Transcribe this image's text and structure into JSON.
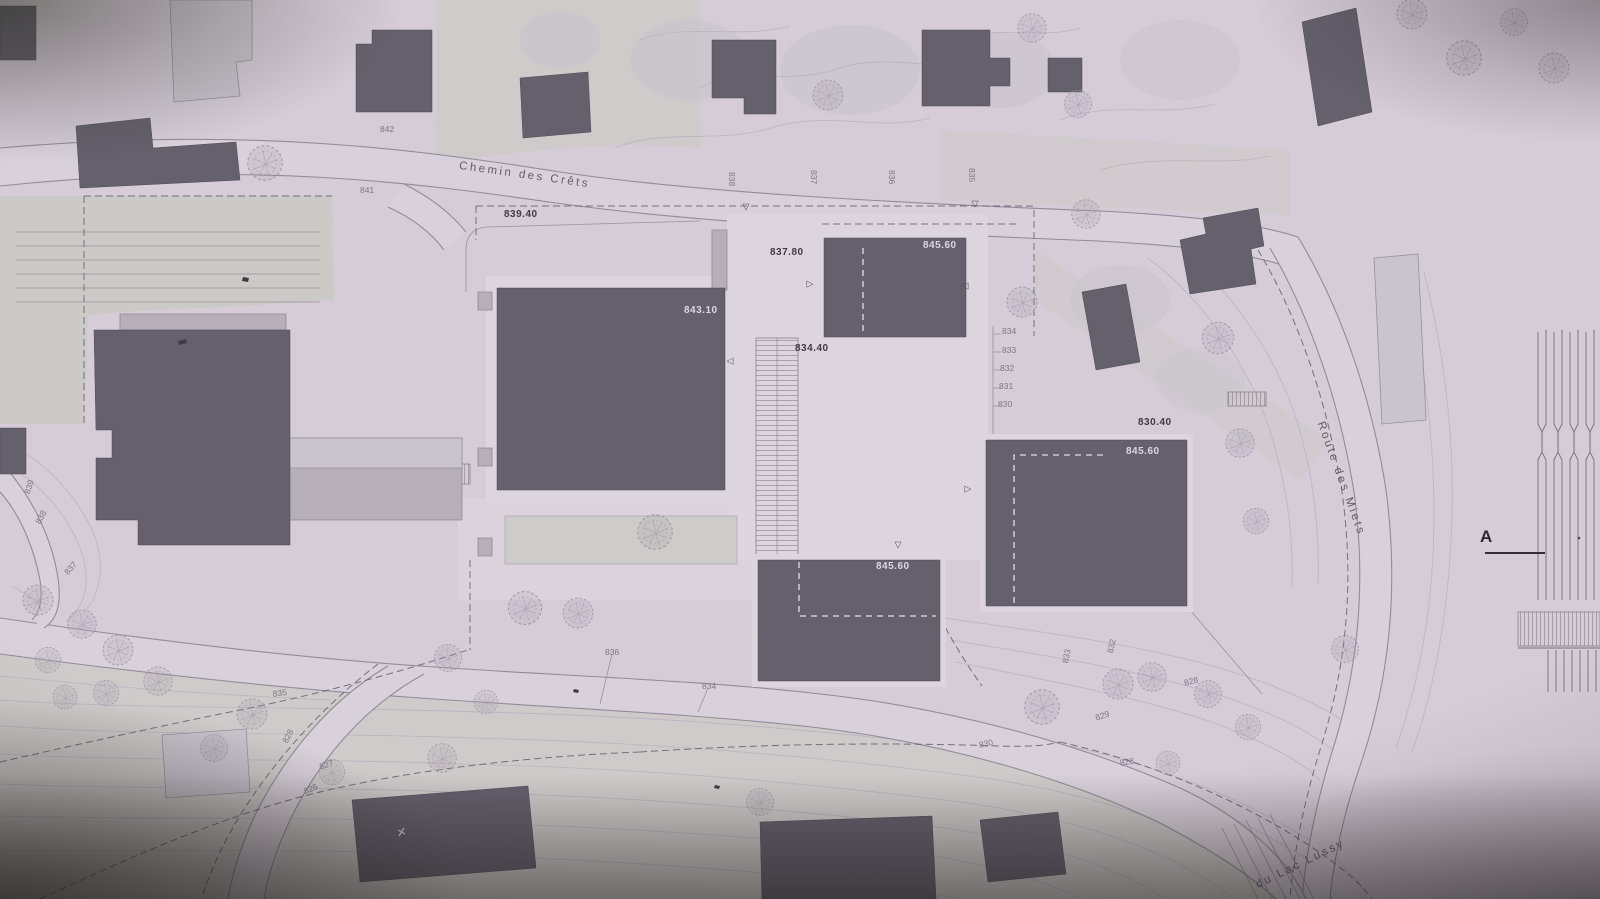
{
  "section": {
    "label": "A"
  },
  "colors": {
    "paper": "#d5cdd7",
    "paper_bright": "#ded7df",
    "parcel": "#c9cbc1",
    "road_fill": "#d9d2da",
    "road_edge": "#8f8996",
    "contour_line": "#b2a9bd",
    "building_dark": "#5e5c67",
    "building_mid": "#b4afb8",
    "building_light": "#c9c5cd",
    "dash_dark": "#5f5a66",
    "label_dark": "#39343f",
    "label_light": "#dcd8e3",
    "label_contour": "#6f6a78",
    "street_label": "#5d5765",
    "marker": "#4c4754",
    "fleck": "#38343e"
  },
  "marker_glyphs": {
    "down": "▽",
    "right": "▷",
    "left": "◁"
  },
  "markers": [
    {
      "type": "down",
      "x": 746,
      "y": 207
    },
    {
      "type": "down",
      "x": 975,
      "y": 204
    },
    {
      "type": "down",
      "x": 898,
      "y": 545
    },
    {
      "type": "right",
      "x": 810,
      "y": 284
    },
    {
      "type": "right",
      "x": 968,
      "y": 489
    },
    {
      "type": "left",
      "x": 965,
      "y": 286
    },
    {
      "type": "left",
      "x": 730,
      "y": 361
    }
  ],
  "labels": [
    {
      "text": "Chemin des Crêts",
      "x": 460,
      "y": 160,
      "rot": 8,
      "cls": "street"
    },
    {
      "text": "Route des Miets",
      "x": 1326,
      "y": 420,
      "rot": 70,
      "cls": "street"
    },
    {
      "text": "du Lac Lussy",
      "x": 1254,
      "y": 880,
      "rot": -26,
      "cls": "street"
    },
    {
      "text": "839.40",
      "x": 504,
      "y": 209,
      "rot": 0,
      "cls": "elev"
    },
    {
      "text": "837.80",
      "x": 770,
      "y": 247,
      "rot": 0,
      "cls": "elev"
    },
    {
      "text": "834.40",
      "x": 795,
      "y": 343,
      "rot": 0,
      "cls": "elev"
    },
    {
      "text": "830.40",
      "x": 1138,
      "y": 417,
      "rot": 0,
      "cls": "elev"
    },
    {
      "text": "843.10",
      "x": 684,
      "y": 305,
      "rot": 0,
      "cls": "roof"
    },
    {
      "text": "845.60",
      "x": 923,
      "y": 240,
      "rot": 0,
      "cls": "roof"
    },
    {
      "text": "845.60",
      "x": 1126,
      "y": 446,
      "rot": 0,
      "cls": "roof"
    },
    {
      "text": "845.60",
      "x": 876,
      "y": 561,
      "rot": 0,
      "cls": "roof"
    },
    {
      "text": "842",
      "x": 380,
      "y": 124,
      "rot": 0,
      "cls": "contour"
    },
    {
      "text": "841",
      "x": 360,
      "y": 185,
      "rot": 0,
      "cls": "contour"
    },
    {
      "text": "838",
      "x": 737,
      "y": 172,
      "rot": 90,
      "cls": "contour"
    },
    {
      "text": "837",
      "x": 819,
      "y": 170,
      "rot": 90,
      "cls": "contour"
    },
    {
      "text": "836",
      "x": 897,
      "y": 170,
      "rot": 90,
      "cls": "contour"
    },
    {
      "text": "835",
      "x": 977,
      "y": 168,
      "rot": 90,
      "cls": "contour"
    },
    {
      "text": "834",
      "x": 1002,
      "y": 326,
      "rot": 0,
      "cls": "contour"
    },
    {
      "text": "833",
      "x": 1002,
      "y": 345,
      "rot": 0,
      "cls": "contour"
    },
    {
      "text": "832",
      "x": 1000,
      "y": 363,
      "rot": 0,
      "cls": "contour"
    },
    {
      "text": "831",
      "x": 999,
      "y": 381,
      "rot": 0,
      "cls": "contour"
    },
    {
      "text": "830",
      "x": 998,
      "y": 399,
      "rot": 0,
      "cls": "contour"
    },
    {
      "text": "839",
      "x": 22,
      "y": 492,
      "rot": -72,
      "cls": "contour"
    },
    {
      "text": "838",
      "x": 33,
      "y": 521,
      "rot": -62,
      "cls": "contour"
    },
    {
      "text": "837",
      "x": 62,
      "y": 570,
      "rot": -48,
      "cls": "contour"
    },
    {
      "text": "836",
      "x": 605,
      "y": 647,
      "rot": 0,
      "cls": "contour"
    },
    {
      "text": "834",
      "x": 702,
      "y": 681,
      "rot": 0,
      "cls": "contour"
    },
    {
      "text": "835",
      "x": 272,
      "y": 689,
      "rot": -8,
      "cls": "contour"
    },
    {
      "text": "828",
      "x": 280,
      "y": 740,
      "rot": -62,
      "cls": "contour"
    },
    {
      "text": "827",
      "x": 318,
      "y": 762,
      "rot": -18,
      "cls": "contour"
    },
    {
      "text": "826",
      "x": 302,
      "y": 787,
      "rot": -24,
      "cls": "contour"
    },
    {
      "text": "830",
      "x": 978,
      "y": 740,
      "rot": -12,
      "cls": "contour"
    },
    {
      "text": "829",
      "x": 1094,
      "y": 713,
      "rot": -18,
      "cls": "contour"
    },
    {
      "text": "828",
      "x": 1119,
      "y": 758,
      "rot": -10,
      "cls": "contour"
    },
    {
      "text": "828",
      "x": 1183,
      "y": 678,
      "rot": -14,
      "cls": "contour"
    },
    {
      "text": "833",
      "x": 1060,
      "y": 662,
      "rot": -78,
      "cls": "contour"
    },
    {
      "text": "832",
      "x": 1105,
      "y": 652,
      "rot": -78,
      "cls": "contour"
    }
  ]
}
